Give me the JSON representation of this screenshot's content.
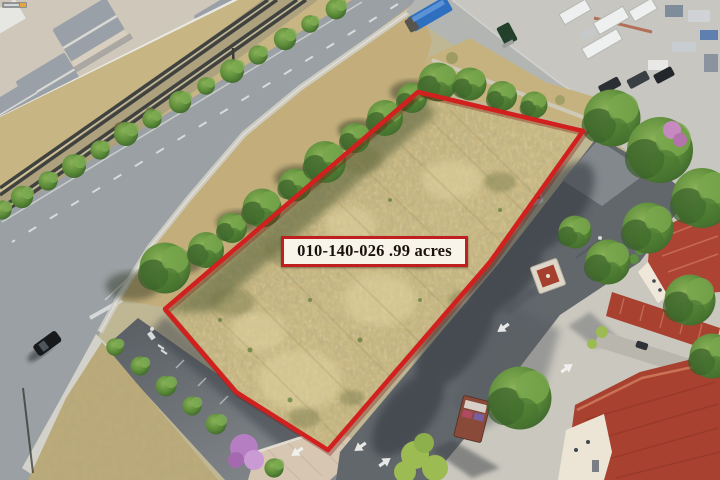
{
  "photo": {
    "description": "Aerial drone photo of a vacant dry-grass land parcel outlined in red at a suburban corner; railroad tracks, a tree-lined street and homes to the northwest, a Spanish-tile-roof commercial center with parking lots to the southeast.",
    "annotation": {
      "parcel_label_text": "010-140-026 .99 acres",
      "apn": "010-140-026",
      "acreage_text": ".99 acres",
      "outline_color": "#d2201e",
      "label_background": "#f8f4ea",
      "label_border_color": "#c01f20",
      "label_text_color": "#18120c"
    },
    "watermark": {
      "position": "top-left",
      "legible": false
    },
    "palette": {
      "dry_grass": "#c4b17c",
      "tree_green": "#4f7c33",
      "street_gray": "#9aa0a3",
      "shadow_asphalt": "#565b60",
      "concrete": "#c8c6bf",
      "tile_roof_red": "#a8412f",
      "rail_corridor_tan": "#c7b583"
    }
  }
}
